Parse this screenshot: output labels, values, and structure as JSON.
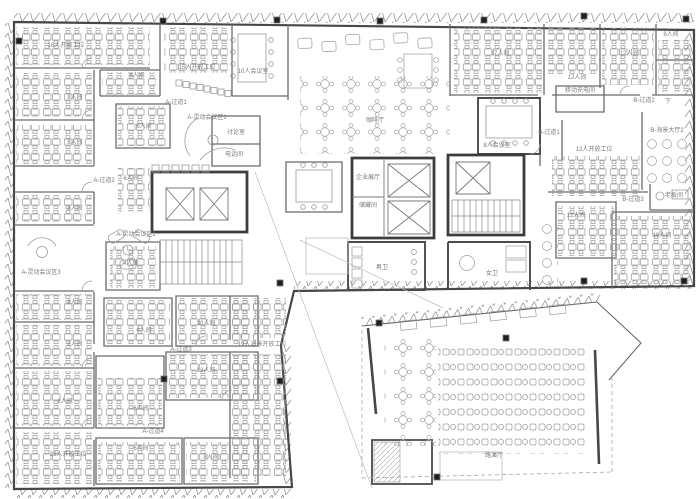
{
  "drawing": {
    "type": "architectural-floor-plan",
    "description": "office floor plan with open workstations, meeting rooms, cafe and roadshow hall",
    "language": "zh-CN"
  },
  "colors": {
    "background": "#ffffff",
    "outer_wall": "#474747",
    "partition": "#6a6a6a",
    "core_wall": "#3d3d3d",
    "furniture": "#9b9b9b",
    "label_text": "#7a7a7a",
    "column_marker": "#1f1f1f",
    "dashed_line": "#a8a8a8"
  },
  "rooms": [
    {
      "label": "16人开放工位",
      "x": 66,
      "y": 46
    },
    {
      "label": "8人间",
      "x": 75,
      "y": 98
    },
    {
      "label": "8人间",
      "x": 75,
      "y": 143
    },
    {
      "label": "A-过道2",
      "x": 104,
      "y": 181
    },
    {
      "label": "8人间",
      "x": 75,
      "y": 209
    },
    {
      "label": "A-灵动会议区3",
      "x": 41,
      "y": 273
    },
    {
      "label": "8人间",
      "x": 75,
      "y": 303
    },
    {
      "label": "8人间",
      "x": 75,
      "y": 345
    },
    {
      "label": "8人间",
      "x": 65,
      "y": 402
    },
    {
      "label": "23人开放工位",
      "x": 68,
      "y": 455
    },
    {
      "label": "6人间",
      "x": 137,
      "y": 76
    },
    {
      "label": "15人开放工位",
      "x": 197,
      "y": 68
    },
    {
      "label": "10人会议室",
      "x": 253,
      "y": 72
    },
    {
      "label": "A-过道1",
      "x": 176,
      "y": 103
    },
    {
      "label": "A-灵动会议区1",
      "x": 207,
      "y": 118
    },
    {
      "label": "6人间",
      "x": 144,
      "y": 127
    },
    {
      "label": "讨论室",
      "x": 236,
      "y": 133
    },
    {
      "label": "电话间",
      "x": 234,
      "y": 155
    },
    {
      "label": "6人间",
      "x": 131,
      "y": 179
    },
    {
      "label": "A-灵动会议区2",
      "x": 136,
      "y": 235
    },
    {
      "label": "4人间",
      "x": 131,
      "y": 264
    },
    {
      "label": "6人间",
      "x": 144,
      "y": 331
    },
    {
      "label": "10人间",
      "x": 206,
      "y": 324
    },
    {
      "label": "A-过道3",
      "x": 181,
      "y": 350
    },
    {
      "label": "12人间",
      "x": 206,
      "y": 371
    },
    {
      "label": "6人间",
      "x": 141,
      "y": 409
    },
    {
      "label": "A-过道4",
      "x": 153,
      "y": 432
    },
    {
      "label": "6人间",
      "x": 141,
      "y": 449
    },
    {
      "label": "8人间",
      "x": 211,
      "y": 458
    },
    {
      "label": "19人海景开放工位",
      "x": 262,
      "y": 345
    },
    {
      "label": "咖啡厅",
      "x": 375,
      "y": 121
    },
    {
      "label": "企业展厅",
      "x": 368,
      "y": 178
    },
    {
      "label": "储藏间",
      "x": 368,
      "y": 206
    },
    {
      "label": "男卫",
      "x": 382,
      "y": 268
    },
    {
      "label": "女卫",
      "x": 492,
      "y": 274
    },
    {
      "label": "17人间",
      "x": 500,
      "y": 54
    },
    {
      "label": "12人间",
      "x": 577,
      "y": 78
    },
    {
      "label": "12人间",
      "x": 629,
      "y": 54
    },
    {
      "label": "8人间",
      "x": 671,
      "y": 35
    },
    {
      "label": "移动充电间",
      "x": 580,
      "y": 91
    },
    {
      "label": "B-过道2",
      "x": 644,
      "y": 101
    },
    {
      "label": "下",
      "x": 668,
      "y": 102
    },
    {
      "label": "8人会议室",
      "x": 497,
      "y": 146
    },
    {
      "label": "B-过道1",
      "x": 549,
      "y": 133
    },
    {
      "label": "12人开放工位",
      "x": 594,
      "y": 150
    },
    {
      "label": "B-海景大厅2",
      "x": 667,
      "y": 131
    },
    {
      "label": "12人间",
      "x": 576,
      "y": 216
    },
    {
      "label": "B-过道3",
      "x": 633,
      "y": 200
    },
    {
      "label": "老板间",
      "x": 674,
      "y": 196
    },
    {
      "label": "19人间",
      "x": 662,
      "y": 236
    },
    {
      "label": "路演厅",
      "x": 494,
      "y": 456
    }
  ],
  "column_markers": [
    [
      19,
      41
    ],
    [
      163,
      21
    ],
    [
      277,
      20
    ],
    [
      380,
      21
    ],
    [
      484,
      20
    ],
    [
      584,
      16
    ],
    [
      686,
      19
    ],
    [
      280,
      283
    ],
    [
      584,
      281
    ],
    [
      684,
      281
    ],
    [
      164,
      379
    ],
    [
      280,
      381
    ],
    [
      379,
      323
    ],
    [
      506,
      338
    ],
    [
      437,
      477
    ]
  ]
}
